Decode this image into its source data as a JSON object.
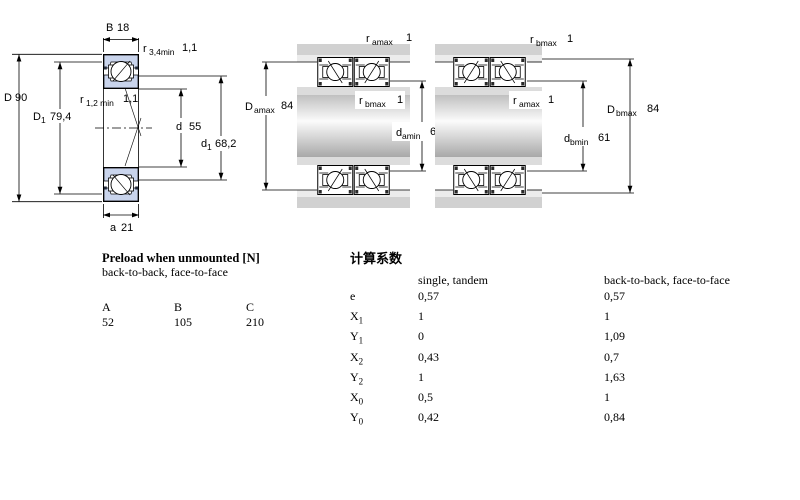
{
  "colors": {
    "ring_fill": "#c9d4ec",
    "housing_band": "#d1d1d1",
    "housing_band_light": "#ececec",
    "shoulder_band": "#dcdcdc",
    "line": "#000000",
    "background": "#ffffff"
  },
  "left_diagram": {
    "labels": {
      "B": {
        "sym": "B",
        "sub": "",
        "val": "18"
      },
      "r34": {
        "sym": "r",
        "sub": "3,4min",
        "val": "1,1"
      },
      "D": {
        "sym": "D",
        "sub": "",
        "val": "90"
      },
      "D1": {
        "sym": "D",
        "sub": "1",
        "val": "79,4"
      },
      "r12": {
        "sym": "r",
        "sub": "1,2 min",
        "val": "1,1"
      },
      "d": {
        "sym": "d",
        "sub": "",
        "val": "55"
      },
      "d1": {
        "sym": "d",
        "sub": "1",
        "val": "68,2"
      },
      "a": {
        "sym": "a",
        "sub": "",
        "val": "21"
      }
    }
  },
  "middle_diagram": {
    "labels": {
      "r_amax_top": {
        "sym": "r",
        "sub": "amax",
        "val": "1"
      },
      "D_amax": {
        "sym": "D",
        "sub": "amax",
        "val": "84"
      },
      "r_bmax": {
        "sym": "r",
        "sub": "bmax",
        "val": "1"
      },
      "d_amin": {
        "sym": "d",
        "sub": "amin",
        "val": "61"
      }
    }
  },
  "right_diagram": {
    "labels": {
      "r_bmax_top": {
        "sym": "r",
        "sub": "bmax",
        "val": "1"
      },
      "r_amax": {
        "sym": "r",
        "sub": "amax",
        "val": "1"
      },
      "d_bmin": {
        "sym": "d",
        "sub": "bmin",
        "val": "61"
      },
      "D_bmax": {
        "sym": "D",
        "sub": "bmax",
        "val": "84"
      }
    }
  },
  "preload_table": {
    "title": "Preload when unmounted [N]",
    "subtitle": "back-to-back, face-to-face",
    "columns": [
      "A",
      "B",
      "C"
    ],
    "values": [
      "52",
      "105",
      "210"
    ]
  },
  "factors_table": {
    "title": "计算系数",
    "col_single": "single, tandem",
    "col_paired": "back-to-back, face-to-face",
    "rows": [
      {
        "sym": "e",
        "sub": "",
        "single": "0,57",
        "paired": "0,57"
      },
      {
        "sym": "X",
        "sub": "1",
        "single": "1",
        "paired": "1"
      },
      {
        "sym": "Y",
        "sub": "1",
        "single": "0",
        "paired": "1,09"
      },
      {
        "sym": "X",
        "sub": "2",
        "single": "0,43",
        "paired": "0,7"
      },
      {
        "sym": "Y",
        "sub": "2",
        "single": "1",
        "paired": "1,63"
      },
      {
        "sym": "X",
        "sub": "0",
        "single": "0,5",
        "paired": "1"
      },
      {
        "sym": "Y",
        "sub": "0",
        "single": "0,42",
        "paired": "0,84"
      }
    ]
  }
}
